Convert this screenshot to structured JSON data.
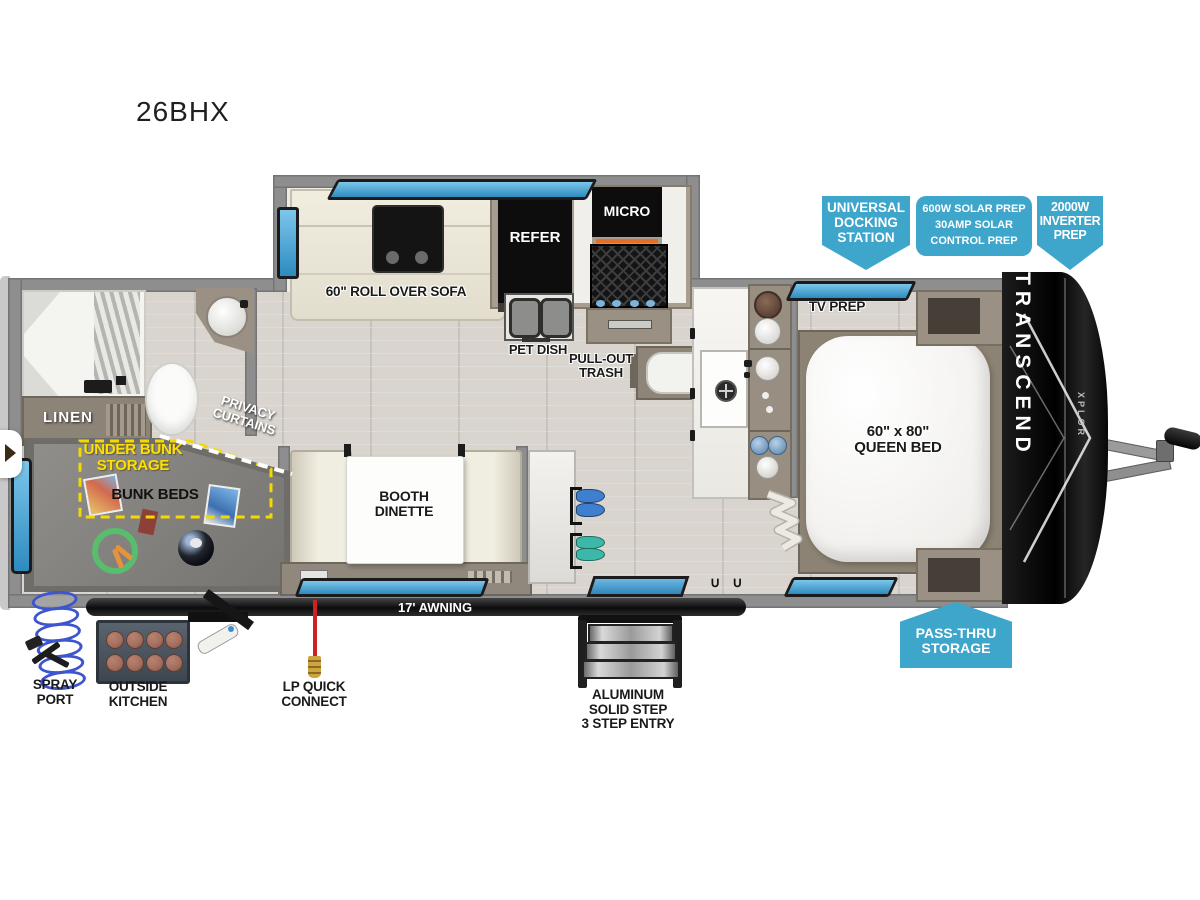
{
  "title": "26BHX",
  "branding": {
    "model": "TRANSCEND",
    "trim": "XPLOR"
  },
  "callouts": {
    "docking": "UNIVERSAL\nDOCKING\nSTATION",
    "solar": "600W SOLAR PREP\n30AMP SOLAR\nCONTROL PREP",
    "inverter": "2000W\nINVERTER\nPREP",
    "passthru": "PASS-THRU\nSTORAGE"
  },
  "rooms": {
    "sofa": "60\" ROLL OVER SOFA",
    "refer": "REFER",
    "micro": "MICRO",
    "pet_dish": "PET DISH",
    "pull_out_trash": "PULL-OUT\nTRASH",
    "tv_prep": "TV PREP",
    "queen_bed": "60\" x 80\"\nQUEEN BED",
    "linen": "LINEN",
    "privacy_curtains": "PRIVACY\nCURTAINS",
    "under_bunk_storage": "UNDER BUNK\nSTORAGE",
    "bunk_beds": "BUNK BEDS",
    "booth_dinette": "BOOTH\nDINETTE",
    "awning": "17' AWNING"
  },
  "exterior": {
    "spray_port": "SPRAY\nPORT",
    "outside_kitchen": "OUTSIDE\nKITCHEN",
    "lp_quick_connect": "LP QUICK\nCONNECT",
    "entry_step": "ALUMINUM\nSOLID STEP\n3 STEP ENTRY"
  },
  "colors": {
    "callout_blue": "#3EA5CB",
    "window_blue": "#4FA9D8",
    "storage_yellow": "#F2D900",
    "accent_orange": "#E07028",
    "lp_red": "#CC2222"
  }
}
